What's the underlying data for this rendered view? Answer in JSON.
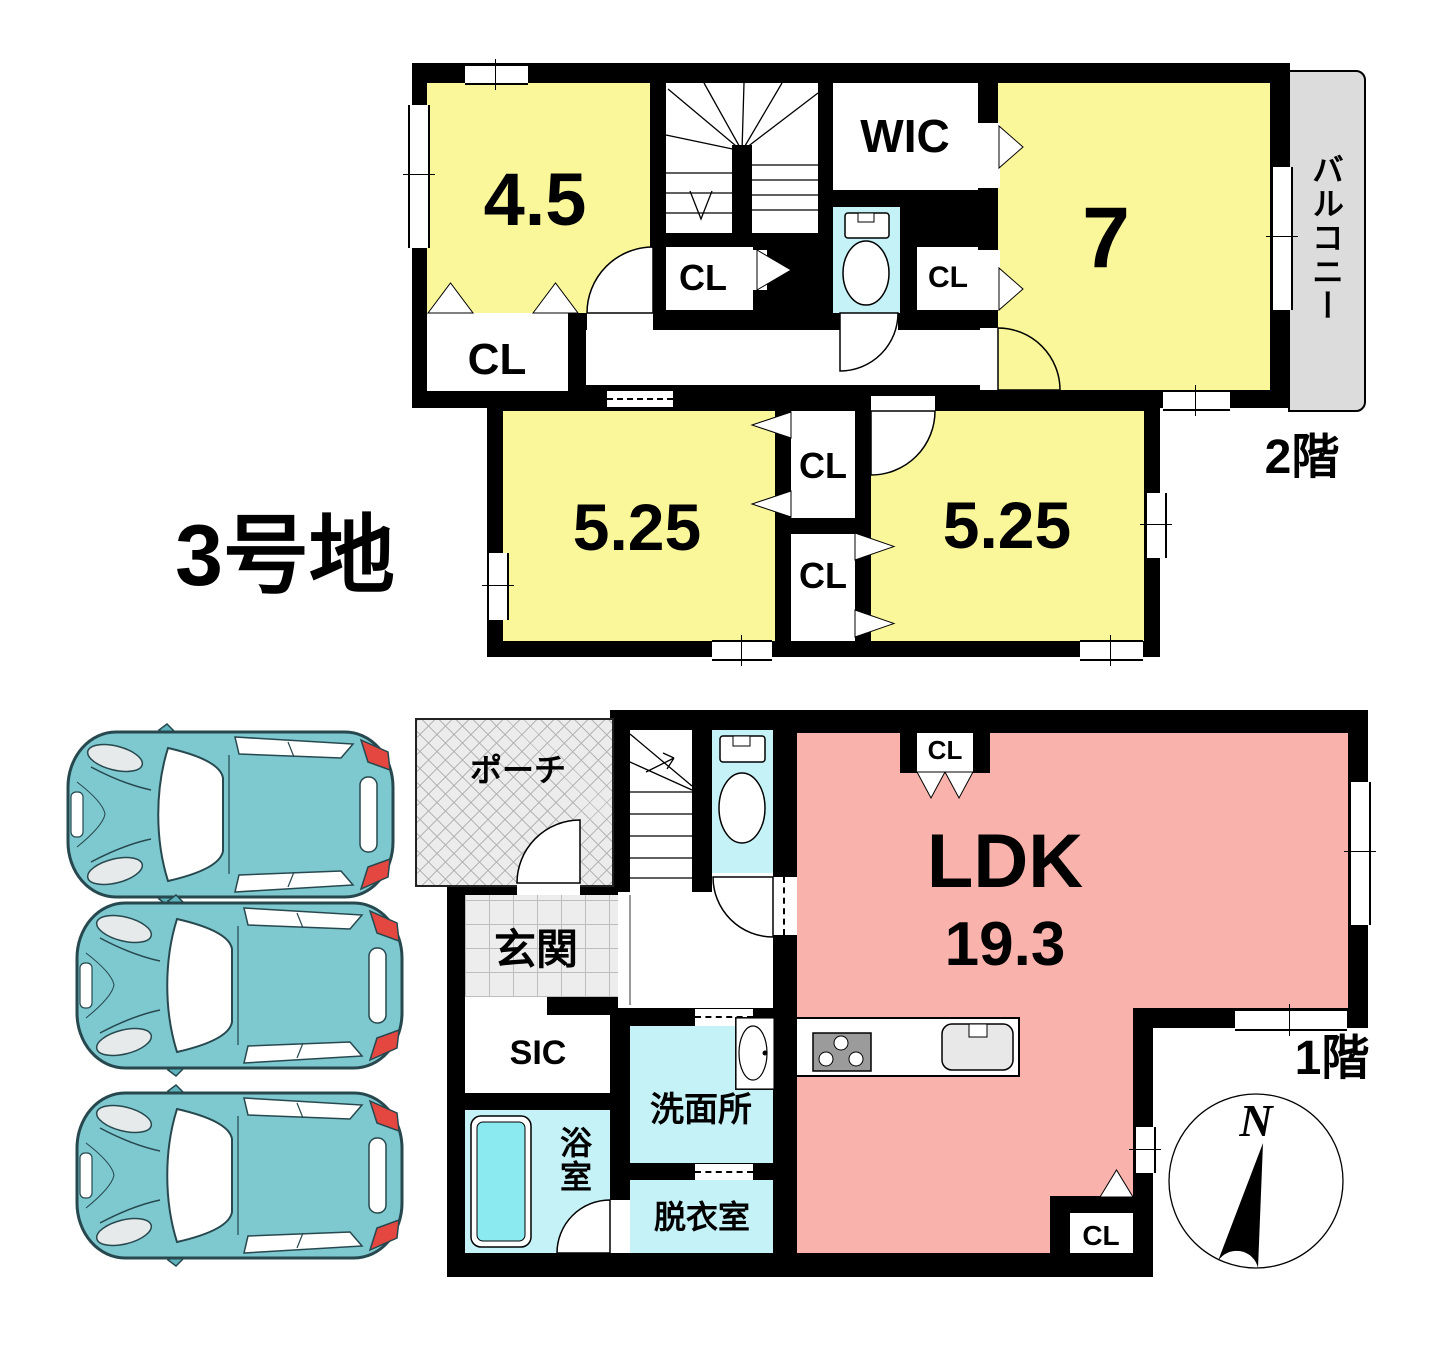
{
  "lot": {
    "title": "3号地"
  },
  "floor2": {
    "floor_label": "2階",
    "room_4_5": "4.5",
    "cl_under_4_5": "CL",
    "cl_stair": "CL",
    "wic": "WIC",
    "cl_wic": "CL",
    "room_7": "7",
    "balcony": "バルコニー",
    "room_5_25_left": "5.25",
    "cl_top": "CL",
    "cl_bottom": "CL",
    "room_5_25_right": "5.25"
  },
  "floor1": {
    "floor_label": "1階",
    "porch": "ポーチ",
    "entrance": "玄関",
    "sic": "SIC",
    "bath": "浴室",
    "washroom": "洗面所",
    "dressing_room": "脱衣室",
    "ldk": "LDK",
    "ldk_area": "19.3",
    "cl_ldk_top": "CL",
    "cl_ldk_bottom": "CL"
  },
  "compass": {
    "north": "N"
  },
  "colors": {
    "room_yellow": "#FAF79B",
    "ldk_pink": "#F9B2AC",
    "wet_area_cyan": "#C5F2F7",
    "car_teal": "#7EC8CF",
    "balcony_gray": "#DCDCDC",
    "wall_black": "#000000"
  }
}
